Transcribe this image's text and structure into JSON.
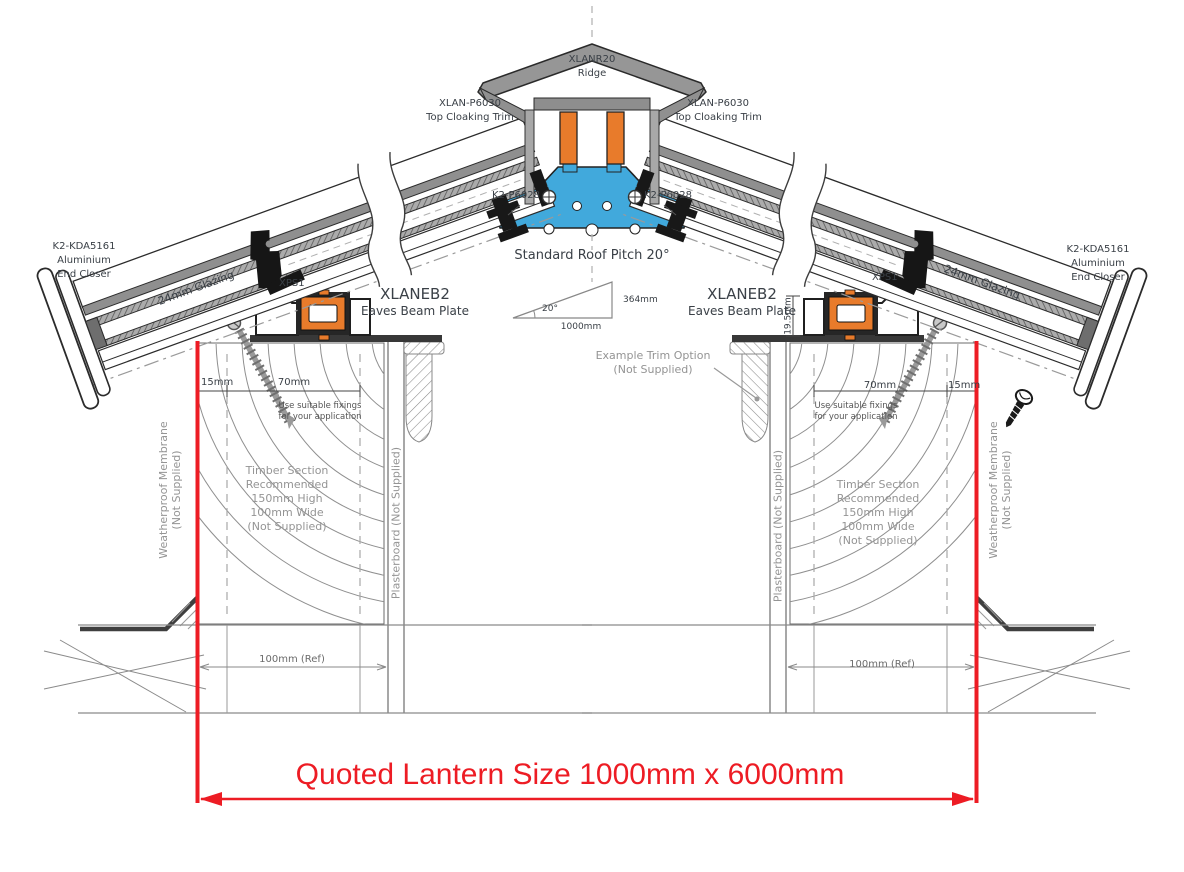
{
  "colors": {
    "accent_orange": "#E87B2B",
    "accent_blue": "#41A9DC",
    "dimension_red": "#ED1C24",
    "line_dark": "#2B2B2B",
    "text_dark": "#3A4047",
    "text_gray": "#949494"
  },
  "ridge": {
    "code": "XLANR20",
    "name": "Ridge"
  },
  "cloaking_trim": {
    "code": "XLAN-P6030",
    "name": "Top Cloaking Trim"
  },
  "glazing_bar_fixing": {
    "code": "K2-P6028"
  },
  "pitch": {
    "title": "Standard Roof Pitch 20°",
    "angle": "20°",
    "run": "1000mm",
    "rise": "364mm"
  },
  "eaves_beam": {
    "code": "XLANEB2",
    "name": "Eaves Beam Plate"
  },
  "xps": {
    "code": "XPS1"
  },
  "end_closer": {
    "code": "K2-KDA5161",
    "line2": "Aluminium",
    "line3": "End Closer"
  },
  "glazing": {
    "label": "24mm Glazing"
  },
  "trim_option": {
    "line1": "Example Trim Option",
    "line2": "(Not Supplied)"
  },
  "membrane": {
    "line1": "Weatherproof Membrane",
    "line2": "(Not Supplied)"
  },
  "plasterboard": {
    "label": "Plasterboard (Not Supplied)"
  },
  "timber_note": [
    "Timber Section",
    "Recommended",
    "150mm High",
    "100mm Wide",
    "(Not Supplied)"
  ],
  "fixings_note": [
    "Use suitable fixings",
    "for your application"
  ],
  "dims": {
    "d15": "15mm",
    "d70": "70mm",
    "d100": "100mm (Ref)",
    "d19_5": "19.5mm"
  },
  "quoted_size": {
    "label": "Quoted Lantern Size 1000mm x 6000mm"
  }
}
